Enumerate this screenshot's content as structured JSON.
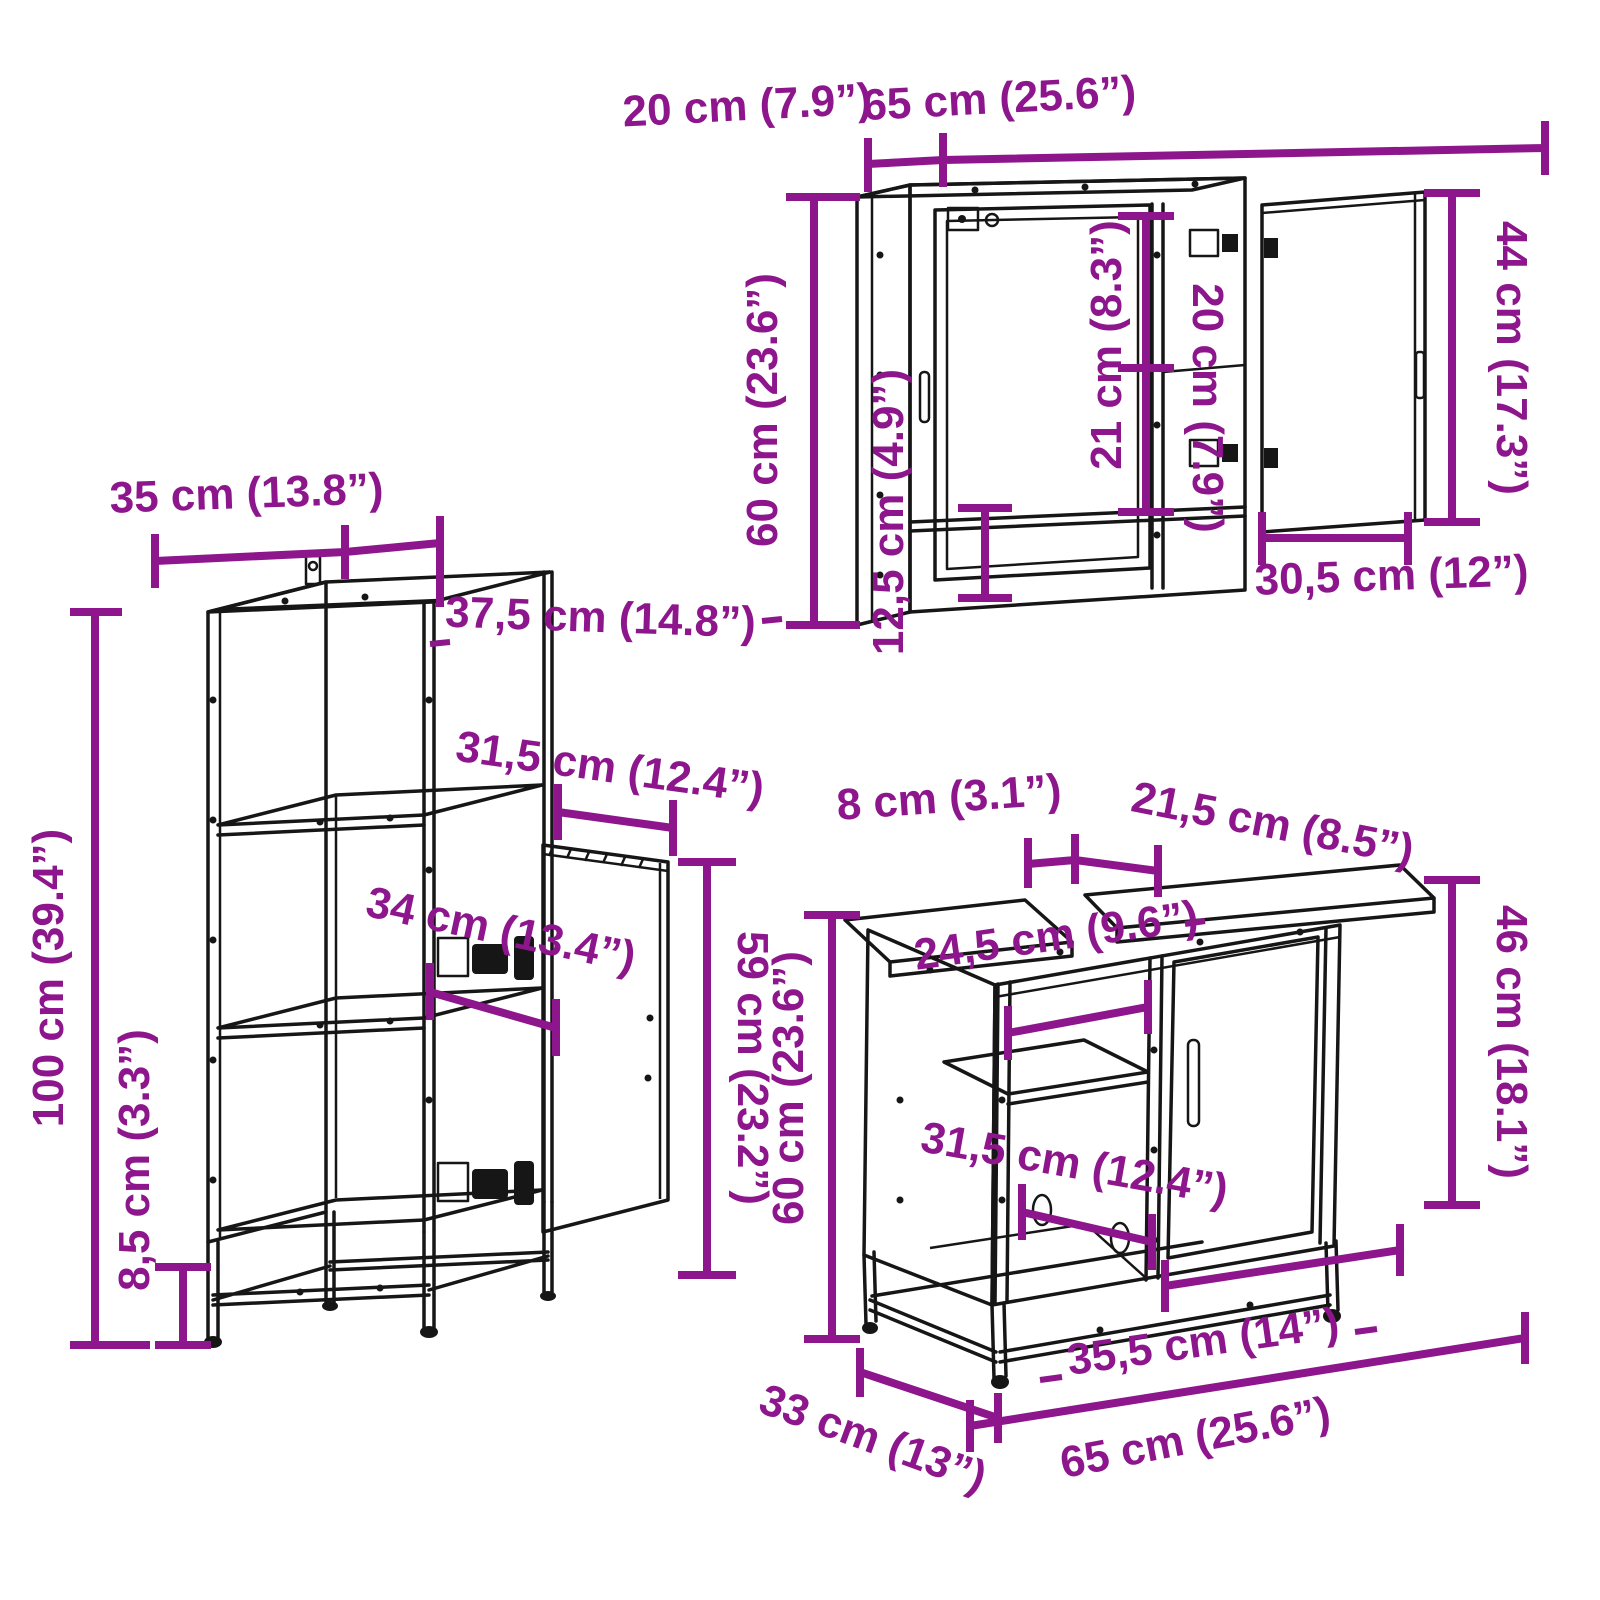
{
  "title": "3 Piece Bathroom Furniture Set dimension diagram",
  "units": {
    "primary": "cm",
    "secondary": "inches"
  },
  "colors": {
    "dimension": "#8d168d",
    "line_art": "#161616",
    "background": "#ffffff"
  },
  "cabinets": {
    "wall_cabinet": {
      "name": "bathroom wall mirror cabinet",
      "labels": {
        "depth_top": "20 cm (7.9”)",
        "width_top": "65 cm (25.6”)",
        "height_left": "60 cm (23.6”)",
        "open_shelf_height": "12,5 cm (4.9”)",
        "top_section_height": "21 cm (8.3”)",
        "right_section_width": "20 cm (7.9”)",
        "door_height": "44 cm (17.3”)",
        "door_width": "30,5 cm (12”)"
      }
    },
    "tall_cabinet": {
      "name": "tall bathroom side cabinet",
      "labels": {
        "width_top": "35 cm (13.8”)",
        "depth_top": "37,5 cm (14.8”)",
        "door_opening_width": "31,5 cm (12.4”)",
        "inner_width": "34 cm (13.4”)",
        "height": "100 cm (39.4”)",
        "base_height": "8,5 cm (3.3”)",
        "door_height": "59 cm (23.2”)"
      }
    },
    "sink_cabinet": {
      "name": "bathroom sink cabinet",
      "labels": {
        "pipe_gap_width": "8 cm (3.1”)",
        "top_right_width": "21,5 cm (8.5”)",
        "door_height": "46 cm (18.1”)",
        "open_shelf_width": "24,5 cm (9.6”)",
        "inner_depth": "31,5 cm (12.4”)",
        "height_left": "60 cm (23.6”)",
        "depth_bottom": "33 cm (13”)",
        "door_width": "35,5 cm (14”)",
        "width_bottom": "65 cm (25.6”)"
      }
    }
  }
}
